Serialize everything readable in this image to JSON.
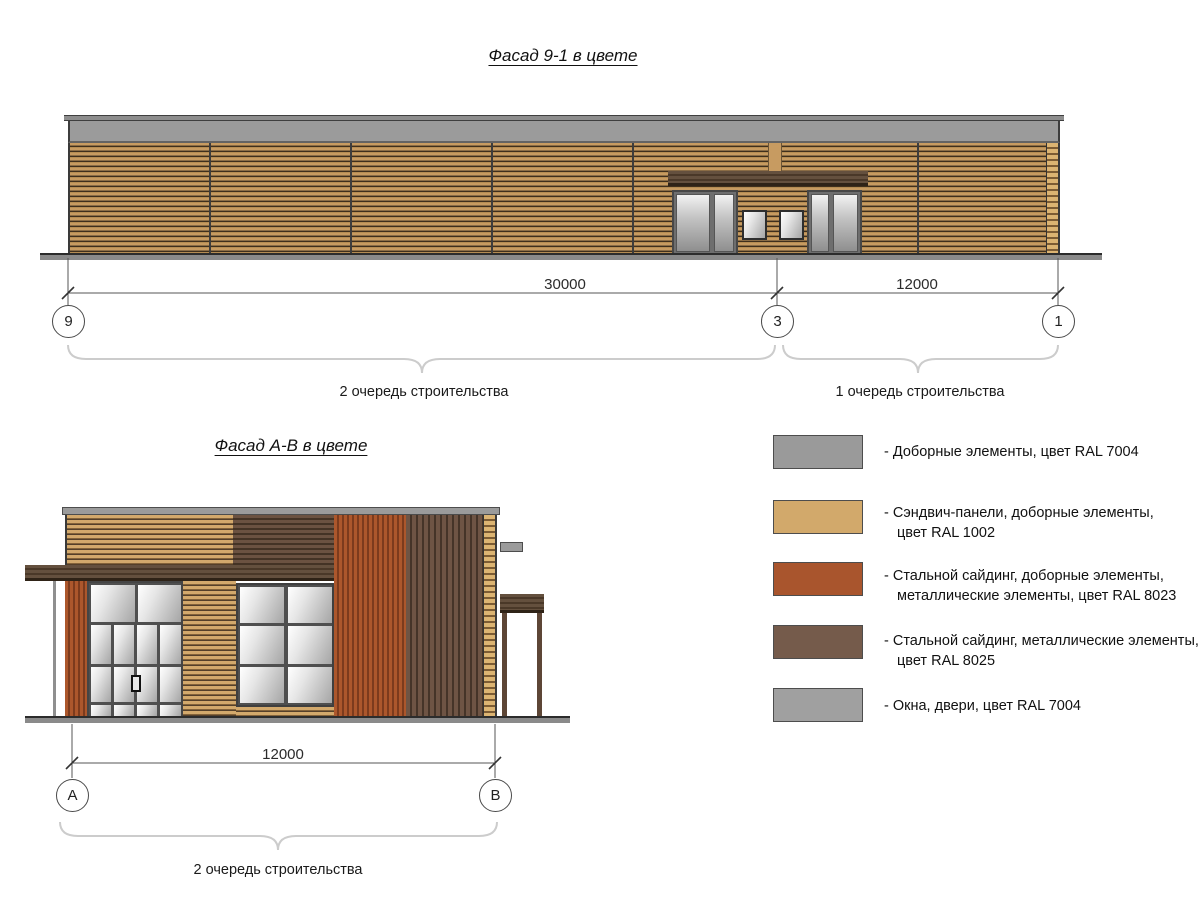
{
  "titles": {
    "top": "Фасад 9-1 в цвете",
    "bottom": "Фасад А-В в цвете"
  },
  "dimensions": {
    "top_span_9_3": "30000",
    "top_span_3_1": "12000",
    "bottom_span_a_b": "12000"
  },
  "axis_markers": {
    "m9": "9",
    "m3": "3",
    "m1": "1",
    "mA": "А",
    "mB": "В"
  },
  "stage_labels": {
    "top_left": "2 очередь строительства",
    "top_right": "1 очередь строительства",
    "bottom": "2 очередь строительства"
  },
  "legend": {
    "items": [
      {
        "color": "#9A9A9A",
        "label": "- Доборные элементы, цвет RAL 7004"
      },
      {
        "color": "#D2A96B",
        "label": "- Сэндвич-панели, доборные элементы,\nцвет RAL 1002"
      },
      {
        "color": "#A9552D",
        "label": "- Стальной сайдинг, доборные элементы,\nметаллические элементы, цвет RAL 8023"
      },
      {
        "color": "#755B4B",
        "label": "- Стальной сайдинг, металлические элементы,\nцвет RAL 8025"
      },
      {
        "color": "#A0A0A0",
        "label": "- Окна, двери, цвет RAL 7004"
      }
    ]
  },
  "palette": {
    "ral7004": "#9B9B9B",
    "ral1002": "#D2A96B",
    "ral8023": "#A9552D",
    "ral8025": "#755B4B"
  }
}
